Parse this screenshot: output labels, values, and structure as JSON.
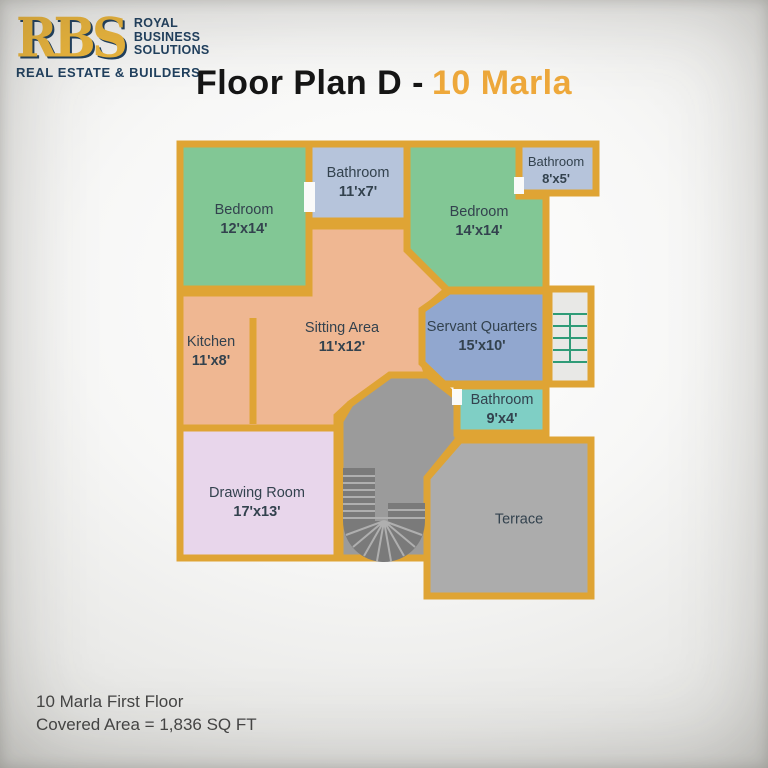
{
  "logo": {
    "monogram": "RBS",
    "lines": [
      "ROYAL",
      "BUSINESS",
      "SOLUTIONS"
    ],
    "tagline": "REAL ESTATE & BUILDERS"
  },
  "title": {
    "prefix": "Floor Plan D -",
    "highlight": "10 Marla"
  },
  "rooms": [
    {
      "id": "bedroom-1",
      "name": "Bedroom",
      "dims": "12'x14'"
    },
    {
      "id": "bathroom-top",
      "name": "Bathroom",
      "dims": "11'x7'"
    },
    {
      "id": "bedroom-2",
      "name": "Bedroom",
      "dims": "14'x14'"
    },
    {
      "id": "bathroom-small",
      "name": "Bathroom",
      "dims": "8'x5'"
    },
    {
      "id": "kitchen",
      "name": "Kitchen",
      "dims": "11'x8'"
    },
    {
      "id": "sitting-area",
      "name": "Sitting Area",
      "dims": "11'x12'"
    },
    {
      "id": "servant-quarters",
      "name": "Servant Quarters",
      "dims": "15'x10'"
    },
    {
      "id": "bathroom-servant",
      "name": "Bathroom",
      "dims": "9'x4'"
    },
    {
      "id": "drawing-room",
      "name": "Drawing Room",
      "dims": "17'x13'"
    },
    {
      "id": "terrace",
      "name": "Terrace",
      "dims": ""
    }
  ],
  "footer": {
    "line1": "10 Marla First Floor",
    "line2": "Covered Area = 1,836 SQ FT"
  },
  "colors": {
    "wall": "#DFA434",
    "bedroom": "#82C795",
    "bathblue": "#B6C4DB",
    "peach": "#EFB792",
    "servant": "#91A7CF",
    "teal": "#7FCFC5",
    "drawing": "#E8D6EB",
    "terrace": "#ACACAC",
    "hall": "#9B9B9B",
    "stairsbg": "#E8E8E6",
    "stairline": "#2F9B77",
    "tread": "#7A7A7A",
    "treadline": "#AFAFAF",
    "gold": "#EFA93B",
    "navy": "#20405F",
    "label": "#33424E",
    "footertext": "#454545",
    "titleblack": "#161616",
    "bg": "#FAFAF9"
  }
}
